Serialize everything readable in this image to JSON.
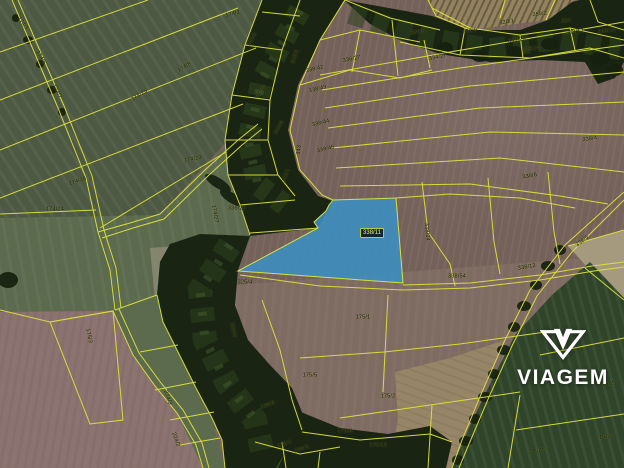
{
  "watermark": {
    "brand": "VIAGEM",
    "logo_icon": "viagem-diamond-logo"
  },
  "map": {
    "type": "cadastral-aerial-view",
    "line_color": "#dde23a",
    "highlighted_parcel": {
      "label": "338/11",
      "fill": "#3b90c1",
      "stroke": "#d8e040",
      "label_bg": "#142731",
      "label_color": "#e8ee5f",
      "label_border": "#b8cc3e"
    },
    "colors": {
      "field_brown": "#74615a",
      "field_brown_light": "#7e6b61",
      "field_green_dark": "#4d5942",
      "field_green_mid": "#5c6a4e",
      "field_green_small": "#3d4d2c",
      "field_green_lawn": "#2f4429",
      "field_pink": "#8b7370",
      "field_tan": "#93825f",
      "tan_band": "#968567",
      "tan_strip": "#a59a7e",
      "pale_patch": "#8f8c74",
      "woods": "#1a2413",
      "hl_label_bg": "#142731",
      "hl_label_color": "#e8ee5f",
      "hl_label_border": "#b8cc3e"
    },
    "parcel_labels": [
      {
        "t": "174/2",
        "x": 233,
        "y": 15,
        "r": -12
      },
      {
        "t": "174/3",
        "x": 22,
        "y": 24,
        "r": 55
      },
      {
        "t": "174/5",
        "x": 40,
        "y": 58,
        "r": 60
      },
      {
        "t": "174/7",
        "x": 56,
        "y": 92,
        "r": 62
      },
      {
        "t": "174/9",
        "x": 185,
        "y": 68,
        "r": -32
      },
      {
        "t": "174/25",
        "x": 140,
        "y": 96,
        "r": -32
      },
      {
        "t": "174/23",
        "x": 193,
        "y": 160,
        "r": -10
      },
      {
        "t": "174/26",
        "x": 78,
        "y": 182,
        "r": -18
      },
      {
        "t": "174/27",
        "x": 214,
        "y": 214,
        "r": 80
      },
      {
        "t": "174/24",
        "x": 55,
        "y": 210,
        "r": 0
      },
      {
        "t": "175/3",
        "x": 88,
        "y": 336,
        "r": 80
      },
      {
        "t": "175/1",
        "x": 363,
        "y": 318,
        "r": 0
      },
      {
        "t": "175/5",
        "x": 310,
        "y": 376,
        "r": 0
      },
      {
        "t": "175/2",
        "x": 388,
        "y": 397,
        "r": 0
      },
      {
        "t": "175/8",
        "x": 345,
        "y": 432,
        "r": 0
      },
      {
        "t": "175/12",
        "x": 378,
        "y": 446,
        "r": 0
      },
      {
        "t": "338/42",
        "x": 315,
        "y": 70,
        "r": -14
      },
      {
        "t": "338/43",
        "x": 318,
        "y": 90,
        "r": -14
      },
      {
        "t": "338/44",
        "x": 321,
        "y": 124,
        "r": -14
      },
      {
        "t": "338/45",
        "x": 326,
        "y": 150,
        "r": -14
      },
      {
        "t": "338/54",
        "x": 457,
        "y": 277,
        "r": 0
      },
      {
        "t": "338/24",
        "x": 426,
        "y": 232,
        "r": 85
      },
      {
        "t": "336/5",
        "x": 418,
        "y": 33,
        "r": -10
      },
      {
        "t": "336/27",
        "x": 352,
        "y": 60,
        "r": -12
      },
      {
        "t": "334/27",
        "x": 438,
        "y": 58,
        "r": -12
      },
      {
        "t": "336/9",
        "x": 470,
        "y": 32,
        "r": -8
      },
      {
        "t": "358/2",
        "x": 540,
        "y": 15,
        "r": -8
      },
      {
        "t": "207",
        "x": 566,
        "y": 22,
        "r": 0
      },
      {
        "t": "320/1",
        "x": 507,
        "y": 23,
        "r": -10
      },
      {
        "t": "336/28",
        "x": 517,
        "y": 41,
        "r": -8
      },
      {
        "t": "263/12",
        "x": 575,
        "y": 33,
        "r": -8
      },
      {
        "t": "263/14",
        "x": 607,
        "y": 32,
        "r": -8
      },
      {
        "t": "336/14",
        "x": 531,
        "y": 50,
        "r": -8
      },
      {
        "t": "338/4",
        "x": 590,
        "y": 140,
        "r": -8
      },
      {
        "t": "338/6",
        "x": 530,
        "y": 177,
        "r": -10
      },
      {
        "t": "338/5",
        "x": 583,
        "y": 242,
        "r": -38
      },
      {
        "t": "338/12",
        "x": 527,
        "y": 268,
        "r": -10
      },
      {
        "t": "215/21",
        "x": 608,
        "y": 385,
        "r": -8
      },
      {
        "t": "215/25",
        "x": 605,
        "y": 438,
        "r": -8
      },
      {
        "t": "215/23",
        "x": 538,
        "y": 452,
        "r": -8
      },
      {
        "t": "346/9",
        "x": 253,
        "y": 40,
        "r": -60
      },
      {
        "t": "345/2",
        "x": 296,
        "y": 57,
        "r": -70
      },
      {
        "t": "345/4",
        "x": 262,
        "y": 92,
        "r": -55
      },
      {
        "t": "344/8",
        "x": 280,
        "y": 128,
        "r": -60
      },
      {
        "t": "343",
        "x": 300,
        "y": 150,
        "r": -85
      },
      {
        "t": "342/1",
        "x": 287,
        "y": 176,
        "r": -70
      },
      {
        "t": "338/20",
        "x": 237,
        "y": 209,
        "r": 0
      },
      {
        "t": "325/4",
        "x": 245,
        "y": 283,
        "r": 0
      },
      {
        "t": "326/4",
        "x": 232,
        "y": 330,
        "r": 80
      },
      {
        "t": "224/3",
        "x": 167,
        "y": 398,
        "r": 70
      },
      {
        "t": "224/2",
        "x": 175,
        "y": 440,
        "r": 70
      },
      {
        "t": "236/9",
        "x": 268,
        "y": 406,
        "r": -20
      },
      {
        "t": "236/1",
        "x": 285,
        "y": 445,
        "r": -20
      },
      {
        "t": "236/3",
        "x": 302,
        "y": 450,
        "r": -20
      }
    ]
  }
}
